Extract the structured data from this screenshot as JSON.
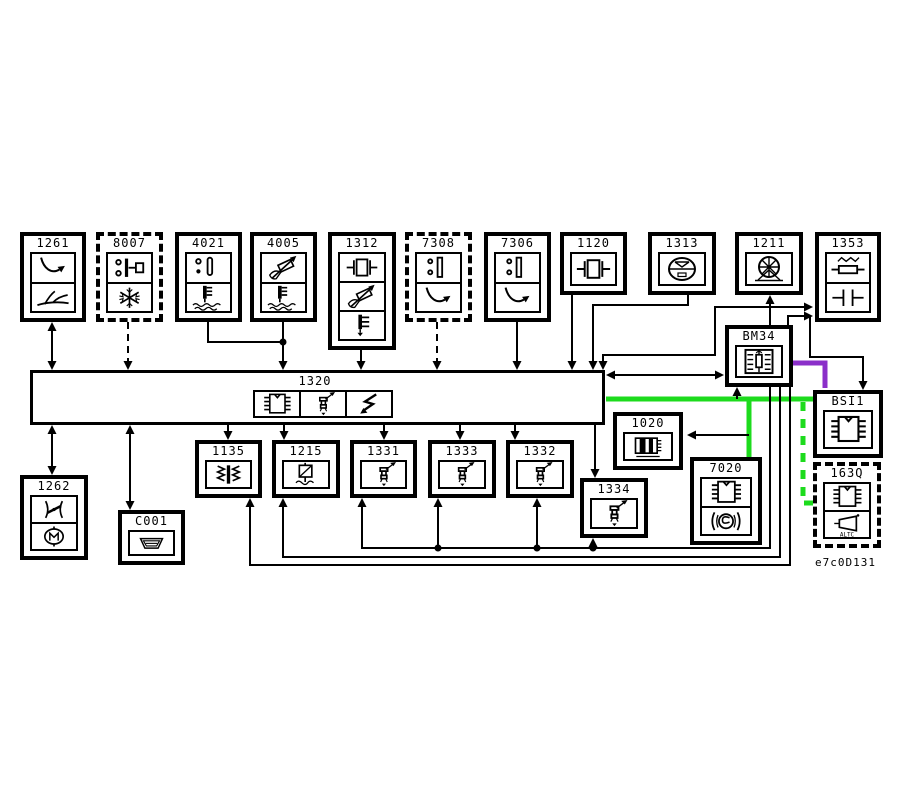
{
  "diagram": {
    "footer_code": "e7c0D131",
    "colors": {
      "background": "#ffffff",
      "wire": "#000000",
      "highlight_green": "#1ddb1d",
      "highlight_purple": "#8b2fc9"
    },
    "components": [
      {
        "id": "1261",
        "x": 20,
        "y": 232,
        "w": 66,
        "h": 90,
        "border": "solid",
        "icons": [
          "curve-arrow",
          "fork-road"
        ]
      },
      {
        "id": "8007",
        "x": 96,
        "y": 232,
        "w": 67,
        "h": 90,
        "border": "dashed",
        "icons": [
          "pressure-switch",
          "snowflake"
        ]
      },
      {
        "id": "4021",
        "x": 175,
        "y": 232,
        "w": 67,
        "h": 90,
        "border": "solid",
        "icons": [
          "level-probe",
          "thermo-liquid"
        ]
      },
      {
        "id": "4005",
        "x": 250,
        "y": 232,
        "w": 67,
        "h": 90,
        "border": "solid",
        "icons": [
          "sensor-arrow",
          "thermo-liquid"
        ]
      },
      {
        "id": "1312",
        "x": 328,
        "y": 232,
        "w": 68,
        "h": 118,
        "border": "solid",
        "icons": [
          "capacitor-box",
          "sensor-arrow",
          "thermo-comb"
        ]
      },
      {
        "id": "7308",
        "x": 405,
        "y": 232,
        "w": 67,
        "h": 90,
        "border": "dashed",
        "icons": [
          "two-dot-switch",
          "curve-arrow"
        ]
      },
      {
        "id": "7306",
        "x": 484,
        "y": 232,
        "w": 67,
        "h": 90,
        "border": "solid",
        "icons": [
          "two-dot-switch",
          "curve-arrow"
        ]
      },
      {
        "id": "1120",
        "x": 560,
        "y": 232,
        "w": 67,
        "h": 63,
        "border": "solid",
        "icons": [
          "capacitor-box"
        ]
      },
      {
        "id": "1313",
        "x": 648,
        "y": 232,
        "w": 68,
        "h": 63,
        "border": "solid",
        "icons": [
          "gauge"
        ]
      },
      {
        "id": "1211",
        "x": 735,
        "y": 232,
        "w": 68,
        "h": 63,
        "border": "solid",
        "icons": [
          "fan-pump"
        ]
      },
      {
        "id": "1353",
        "x": 815,
        "y": 232,
        "w": 66,
        "h": 90,
        "border": "solid",
        "icons": [
          "resistor",
          "capacitor-lines"
        ]
      },
      {
        "id": "1320",
        "x": 30,
        "y": 370,
        "w": 575,
        "h": 55,
        "border": "solid",
        "variant": "ecu",
        "icons": [
          "ic-chip",
          "injector",
          "lightning"
        ]
      },
      {
        "id": "1135",
        "x": 195,
        "y": 440,
        "w": 67,
        "h": 58,
        "border": "solid",
        "icons": [
          "ignition-coil"
        ]
      },
      {
        "id": "1215",
        "x": 272,
        "y": 440,
        "w": 68,
        "h": 58,
        "border": "solid",
        "icons": [
          "throttle-actuator"
        ]
      },
      {
        "id": "1331",
        "x": 350,
        "y": 440,
        "w": 67,
        "h": 58,
        "border": "solid",
        "icons": [
          "injector"
        ]
      },
      {
        "id": "1333",
        "x": 428,
        "y": 440,
        "w": 68,
        "h": 58,
        "border": "solid",
        "icons": [
          "injector"
        ]
      },
      {
        "id": "1332",
        "x": 506,
        "y": 440,
        "w": 68,
        "h": 58,
        "border": "solid",
        "icons": [
          "injector"
        ]
      },
      {
        "id": "1334",
        "x": 580,
        "y": 478,
        "w": 68,
        "h": 60,
        "border": "solid",
        "icons": [
          "injector"
        ]
      },
      {
        "id": "1020",
        "x": 613,
        "y": 412,
        "w": 70,
        "h": 58,
        "border": "solid",
        "icons": [
          "alternator"
        ]
      },
      {
        "id": "7020",
        "x": 690,
        "y": 457,
        "w": 72,
        "h": 88,
        "border": "solid",
        "icons": [
          "ic-chip",
          "pump-coil"
        ]
      },
      {
        "id": "1262",
        "x": 20,
        "y": 475,
        "w": 68,
        "h": 85,
        "border": "solid",
        "icons": [
          "butterfly-valve",
          "motor"
        ]
      },
      {
        "id": "C001",
        "x": 118,
        "y": 510,
        "w": 67,
        "h": 55,
        "border": "solid",
        "icons": [
          "diag-connector"
        ]
      },
      {
        "id": "BM34",
        "x": 725,
        "y": 325,
        "w": 68,
        "h": 62,
        "border": "solid",
        "icons": [
          "fuse-box"
        ]
      },
      {
        "id": "BSI1",
        "x": 813,
        "y": 390,
        "w": 70,
        "h": 68,
        "border": "solid",
        "icons": [
          "ic-chip"
        ]
      },
      {
        "id": "163Q",
        "x": 813,
        "y": 462,
        "w": 68,
        "h": 86,
        "border": "dashed",
        "icons": [
          "ic-chip",
          "horn"
        ],
        "icon_text": "ALTC"
      }
    ],
    "wires": [
      {
        "points": [
          [
            606,
            399
          ],
          [
            813,
            399
          ]
        ],
        "color": "green",
        "width": 5
      },
      {
        "points": [
          [
            749,
            401
          ],
          [
            749,
            457
          ]
        ],
        "color": "green",
        "width": 5
      },
      {
        "points": [
          [
            803,
            402
          ],
          [
            803,
            503
          ],
          [
            813,
            503
          ]
        ],
        "color": "green",
        "width": 5,
        "dashed": true
      },
      {
        "points": [
          [
            793,
            363
          ],
          [
            825,
            363
          ],
          [
            825,
            388
          ]
        ],
        "color": "purple",
        "width": 5
      },
      {
        "points": [
          [
            52,
            326
          ],
          [
            52,
            366
          ]
        ],
        "color": "black"
      },
      {
        "points": [
          [
            128,
            322
          ],
          [
            128,
            366
          ]
        ],
        "color": "black",
        "dashed": true
      },
      {
        "points": [
          [
            208,
            322
          ],
          [
            208,
            342
          ],
          [
            283,
            342
          ]
        ],
        "color": "black"
      },
      {
        "points": [
          [
            283,
            322
          ],
          [
            283,
            366
          ]
        ],
        "color": "black"
      },
      {
        "points": [
          [
            361,
            350
          ],
          [
            361,
            366
          ]
        ],
        "color": "black"
      },
      {
        "points": [
          [
            437,
            322
          ],
          [
            437,
            366
          ]
        ],
        "color": "black",
        "dashed": true
      },
      {
        "points": [
          [
            517,
            322
          ],
          [
            517,
            366
          ]
        ],
        "color": "black"
      },
      {
        "points": [
          [
            572,
            295
          ],
          [
            572,
            366
          ]
        ],
        "color": "black"
      },
      {
        "points": [
          [
            688,
            295
          ],
          [
            688,
            305
          ],
          [
            593,
            305
          ],
          [
            593,
            366
          ]
        ],
        "color": "black"
      },
      {
        "points": [
          [
            603,
            366
          ],
          [
            603,
            355
          ],
          [
            715,
            355
          ],
          [
            715,
            307
          ],
          [
            809,
            307
          ]
        ],
        "color": "black"
      },
      {
        "points": [
          [
            788,
            325
          ],
          [
            788,
            316
          ],
          [
            809,
            316
          ]
        ],
        "color": "black"
      },
      {
        "points": [
          [
            770,
            325
          ],
          [
            770,
            299
          ]
        ],
        "color": "black"
      },
      {
        "points": [
          [
            609,
            375
          ],
          [
            721,
            375
          ]
        ],
        "color": "black"
      },
      {
        "points": [
          [
            810,
            316
          ],
          [
            810,
            357
          ],
          [
            863,
            357
          ],
          [
            863,
            386
          ]
        ],
        "color": "black"
      },
      {
        "points": [
          [
            228,
            425
          ],
          [
            228,
            436
          ]
        ],
        "color": "black"
      },
      {
        "points": [
          [
            284,
            425
          ],
          [
            284,
            436
          ]
        ],
        "color": "black"
      },
      {
        "points": [
          [
            384,
            425
          ],
          [
            384,
            436
          ]
        ],
        "color": "black"
      },
      {
        "points": [
          [
            460,
            425
          ],
          [
            460,
            436
          ]
        ],
        "color": "black"
      },
      {
        "points": [
          [
            515,
            425
          ],
          [
            515,
            436
          ]
        ],
        "color": "black"
      },
      {
        "points": [
          [
            595,
            425
          ],
          [
            595,
            474
          ]
        ],
        "color": "black"
      },
      {
        "points": [
          [
            52,
            429
          ],
          [
            52,
            471
          ]
        ],
        "color": "black"
      },
      {
        "points": [
          [
            130,
            429
          ],
          [
            130,
            506
          ]
        ],
        "color": "black"
      },
      {
        "points": [
          [
            362,
            502
          ],
          [
            362,
            548
          ],
          [
            770,
            548
          ],
          [
            770,
            387
          ]
        ],
        "color": "black"
      },
      {
        "points": [
          [
            438,
            548
          ],
          [
            438,
            502
          ]
        ],
        "color": "black"
      },
      {
        "points": [
          [
            537,
            548
          ],
          [
            537,
            502
          ]
        ],
        "color": "black"
      },
      {
        "points": [
          [
            593,
            548
          ],
          [
            593,
            542
          ]
        ],
        "color": "black"
      },
      {
        "points": [
          [
            283,
            502
          ],
          [
            283,
            557
          ],
          [
            780,
            557
          ],
          [
            780,
            387
          ]
        ],
        "color": "black"
      },
      {
        "points": [
          [
            250,
            502
          ],
          [
            250,
            565
          ],
          [
            790,
            565
          ],
          [
            790,
            387
          ]
        ],
        "color": "black"
      },
      {
        "points": [
          [
            737,
            399
          ],
          [
            737,
            391
          ]
        ],
        "color": "black"
      },
      {
        "points": [
          [
            749,
            435
          ],
          [
            695,
            435
          ]
        ],
        "color": "black"
      }
    ],
    "arrows": [
      {
        "x": 52,
        "y": 322,
        "dir": "up"
      },
      {
        "x": 52,
        "y": 370,
        "dir": "down"
      },
      {
        "x": 128,
        "y": 370,
        "dir": "down"
      },
      {
        "x": 283,
        "y": 370,
        "dir": "down"
      },
      {
        "x": 361,
        "y": 370,
        "dir": "down"
      },
      {
        "x": 437,
        "y": 370,
        "dir": "down"
      },
      {
        "x": 517,
        "y": 370,
        "dir": "down"
      },
      {
        "x": 572,
        "y": 370,
        "dir": "down"
      },
      {
        "x": 593,
        "y": 370,
        "dir": "down"
      },
      {
        "x": 603,
        "y": 370,
        "dir": "down"
      },
      {
        "x": 813,
        "y": 307,
        "dir": "right"
      },
      {
        "x": 813,
        "y": 316,
        "dir": "right"
      },
      {
        "x": 770,
        "y": 295,
        "dir": "up"
      },
      {
        "x": 606,
        "y": 375,
        "dir": "left"
      },
      {
        "x": 724,
        "y": 375,
        "dir": "right"
      },
      {
        "x": 863,
        "y": 390,
        "dir": "down"
      },
      {
        "x": 228,
        "y": 440,
        "dir": "down"
      },
      {
        "x": 284,
        "y": 440,
        "dir": "down"
      },
      {
        "x": 384,
        "y": 440,
        "dir": "down"
      },
      {
        "x": 460,
        "y": 440,
        "dir": "down"
      },
      {
        "x": 515,
        "y": 440,
        "dir": "down"
      },
      {
        "x": 595,
        "y": 478,
        "dir": "down"
      },
      {
        "x": 52,
        "y": 425,
        "dir": "up"
      },
      {
        "x": 52,
        "y": 475,
        "dir": "down"
      },
      {
        "x": 130,
        "y": 425,
        "dir": "up"
      },
      {
        "x": 130,
        "y": 510,
        "dir": "down"
      },
      {
        "x": 362,
        "y": 498,
        "dir": "up"
      },
      {
        "x": 438,
        "y": 498,
        "dir": "up"
      },
      {
        "x": 537,
        "y": 498,
        "dir": "up"
      },
      {
        "x": 593,
        "y": 538,
        "dir": "up"
      },
      {
        "x": 283,
        "y": 498,
        "dir": "up"
      },
      {
        "x": 250,
        "y": 498,
        "dir": "up"
      },
      {
        "x": 737,
        "y": 387,
        "dir": "up"
      },
      {
        "x": 687,
        "y": 435,
        "dir": "left"
      }
    ],
    "dots": [
      [
        283,
        342
      ],
      [
        438,
        548
      ],
      [
        537,
        548
      ],
      [
        593,
        548
      ]
    ]
  }
}
